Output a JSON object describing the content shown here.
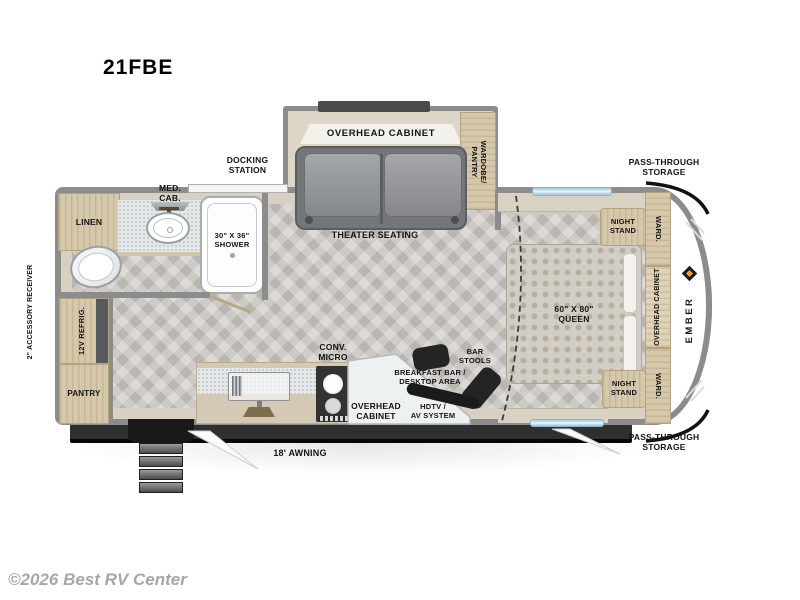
{
  "title": "21FBE",
  "copyright": "©2026 Best RV Center",
  "brand": {
    "name": "EMBER",
    "accent_color": "#f0a030"
  },
  "labels": {
    "docking_station": "DOCKING\nSTATION",
    "pass_through_top": "PASS-THROUGH\nSTORAGE",
    "pass_through_bottom": "PASS-THROUGH\nSTORAGE",
    "accessory_receiver": "2\" ACCESSORY RECEIVER",
    "awning": "18' AWNING",
    "linen": "LINEN",
    "med_cab": "MED.\nCAB.",
    "shower": "30\" X 36\"\nSHOWER",
    "overhead_cabinet_slide": "OVERHEAD CABINET",
    "theater_seating": "THEATER SEATING",
    "wardrobe_pantry": "WARDOBE/\nPANTRY",
    "refrigerator": "12V REFRIG.",
    "pantry": "PANTRY",
    "conv_micro": "CONV.\nMICRO",
    "overhead_cabinet_kitchen": "OVERHEAD\nCABINET",
    "breakfast_bar": "BREAKFAST BAR /\nDESKTOP AREA",
    "hdtv": "HDTV /\nAV SYSTEM",
    "bar_stools": "BAR\nSTOOLS",
    "night_stand_top": "NIGHT\nSTAND",
    "night_stand_bottom": "NIGHT\nSTAND",
    "ward_top": "WARD.",
    "ward_bottom": "WARD.",
    "overhead_cabinet_bedroom": "OVERHEAD CABINET",
    "queen_bed": "60\" X 80\"\nQUEEN"
  },
  "colors": {
    "wall": "#8c8c8c",
    "wood": "#d6c8ab",
    "floor": "#cdc9c4",
    "counter_speckle": "#e4e8e9",
    "sofa": "#84878b",
    "window": "#c3dcea",
    "accent_orange": "#f0a030"
  }
}
